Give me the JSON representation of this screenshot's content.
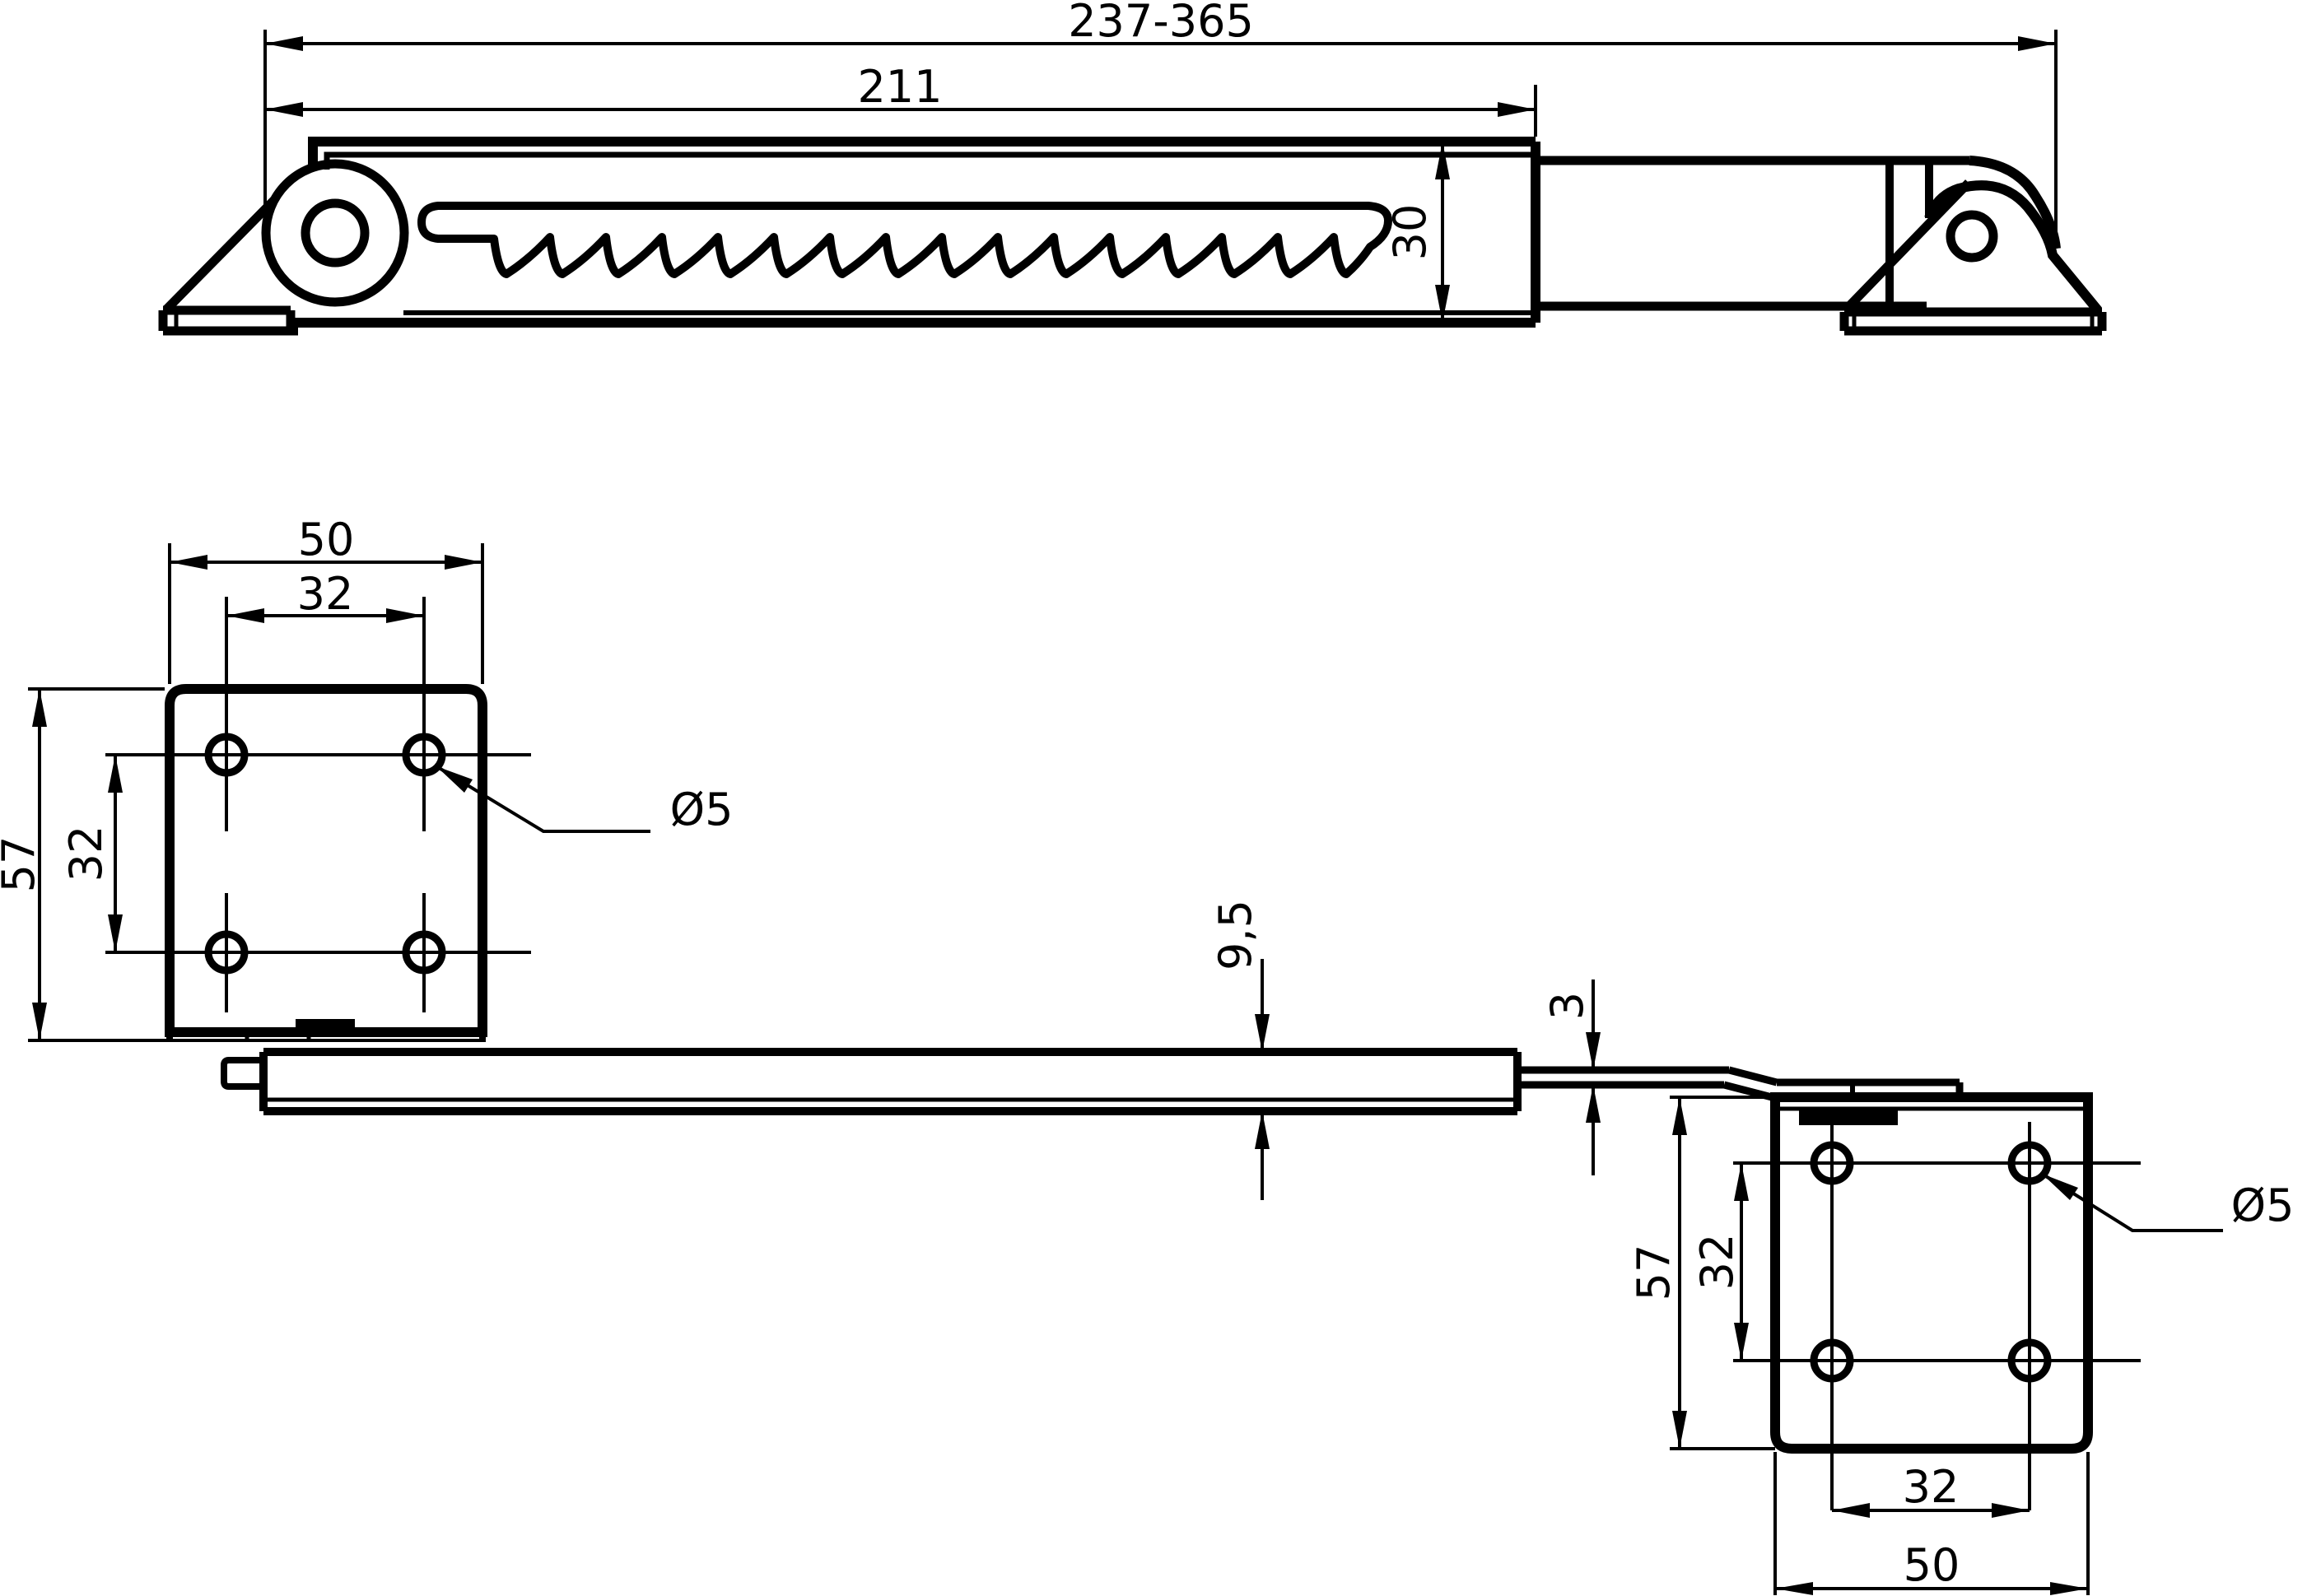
{
  "ink": "#000000",
  "background": "#ffffff",
  "top_view": {
    "overall_length": "237-365",
    "arm_length": "211",
    "arm_height": "30"
  },
  "left_plate": {
    "width": "50",
    "hole_pitch_x": "32",
    "height": "57",
    "hole_pitch_y": "32",
    "hole_diameter": "Ø5"
  },
  "bar": {
    "thickness": "9,5"
  },
  "rod": {
    "thickness": "3"
  },
  "right_plate": {
    "height": "57",
    "hole_pitch_y": "32",
    "hole_diameter": "Ø5",
    "hole_pitch_x": "32",
    "width": "50"
  }
}
